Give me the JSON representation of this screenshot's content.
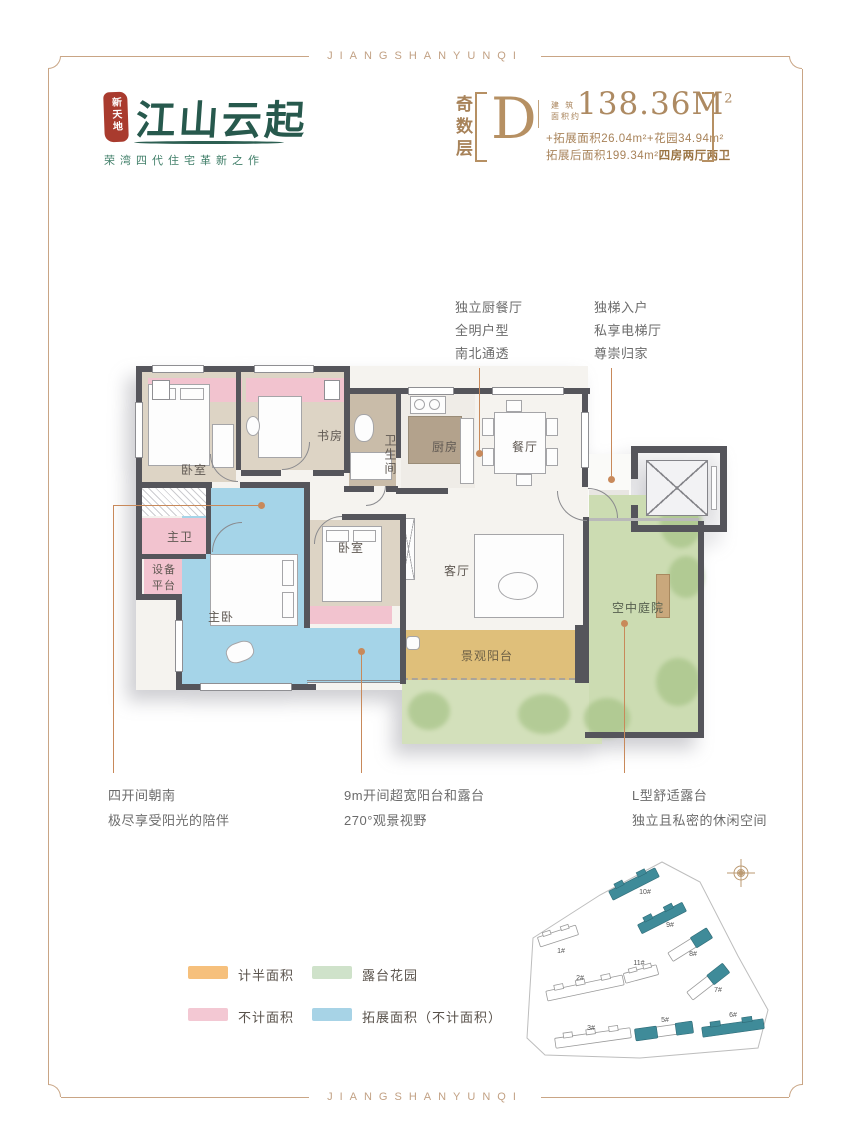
{
  "frame": {
    "top_label": "JIANGSHANYUNQI",
    "bottom_label": "JIANGSHANYUNQI"
  },
  "logo": {
    "seal": "新天地",
    "name": "江山云起",
    "tagline": "荣湾四代住宅革新之作"
  },
  "unit": {
    "floor": "奇数层",
    "letter": "D",
    "area_caption": "建 筑\n面积约",
    "area": "138.36M",
    "area_exp": "2",
    "detail_line1": "+拓展面积26.04m²+花园34.94m²",
    "detail_line2": "拓展后面积199.34m²",
    "detail_line2_bold": "四房两厅两卫"
  },
  "annotations": {
    "kitchen": [
      "独立厨餐厅",
      "全明户型",
      "南北通透"
    ],
    "elevator": [
      "独梯入户",
      "私享电梯厅",
      "尊崇归家"
    ],
    "south": [
      "四开间朝南",
      "极尽享受阳光的陪伴"
    ],
    "balcony": [
      "9m开间超宽阳台和露台",
      "270°观景视野"
    ],
    "terrace": [
      "L型舒适露台",
      "独立且私密的休闲空间"
    ]
  },
  "rooms": {
    "bedroom1": "卧室",
    "study": "书房",
    "bath": "卫生间",
    "kitchen": "厨房",
    "dining": "餐厅",
    "living": "客厅",
    "master_bath": "主卫",
    "equipment": "设备\n平台",
    "master": "主卧",
    "bedroom2": "卧室",
    "view_balcony": "景观阳台",
    "courtyard": "空中庭院"
  },
  "legend": {
    "items": [
      {
        "label": "计半面积",
        "color": "#f6c07c"
      },
      {
        "label": "不计面积",
        "color": "#f3c8d3"
      },
      {
        "label": "露台花园",
        "color": "#cfe2ca"
      },
      {
        "label": "拓展面积（不计面积）",
        "color": "#a7d3e6"
      }
    ]
  },
  "siteplan": {
    "buildings": [
      "1#",
      "2#",
      "3#",
      "5#",
      "6#",
      "7#",
      "8#",
      "9#",
      "10#",
      "11#"
    ],
    "highlight_color": "#3f8b99"
  },
  "colors": {
    "frame": "#c9a585",
    "accent_gold": "#b08a5e",
    "seal_red": "#a93b2e",
    "brand_green": "#2d5f52",
    "wall": "#55555b",
    "half_area": "#efc987",
    "excluded_area": "#f2c3cf",
    "extended_area": "#a5d4e8",
    "terrace_green": "#ccdcb2",
    "leader_line": "#c8895a"
  }
}
